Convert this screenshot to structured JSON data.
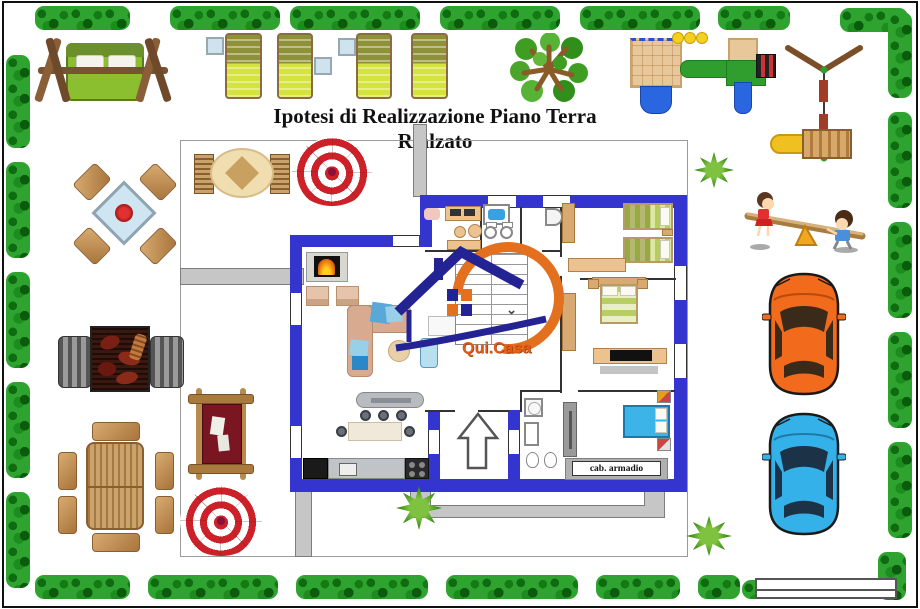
{
  "page": {
    "title": "Ipotesi di Realizzazione Piano Terra Rialzato"
  },
  "branding": {
    "logo_text": "Qui.Casa",
    "logo_orange": "#e2701f",
    "logo_navy": "#232394"
  },
  "floor_plan": {
    "wall_color": "#3434cf",
    "labels": {
      "walk_in_closet": "cab. armadio"
    },
    "elements": [
      "staircase",
      "entrance-arrow",
      "fireplace",
      "kitchen-counter",
      "island-hood",
      "breakfast-table",
      "sofa",
      "armchairs",
      "coffee-table",
      "double-bed",
      "twin-beds",
      "blue-bed",
      "bathtub",
      "washbasins",
      "shower",
      "toilets",
      "wardrobe",
      "tv-unit",
      "desk"
    ]
  },
  "garden": {
    "hedge_color": "#2fa330",
    "items": [
      "garden-swing",
      "sun-loungers",
      "side-tables",
      "tree",
      "playground",
      "swing-set",
      "wooden-slide",
      "seesaw-children",
      "glass-table-with-chairs",
      "barbecue-grill",
      "wooden-dining-set",
      "red-cushion-lounger",
      "beach-umbrella",
      "oval-table-with-benches",
      "grass-tufts"
    ]
  },
  "cars": {
    "orange": "#f26a1c",
    "blue": "#35b1ea"
  },
  "legend_box": {
    "rows": 2,
    "text": ""
  }
}
